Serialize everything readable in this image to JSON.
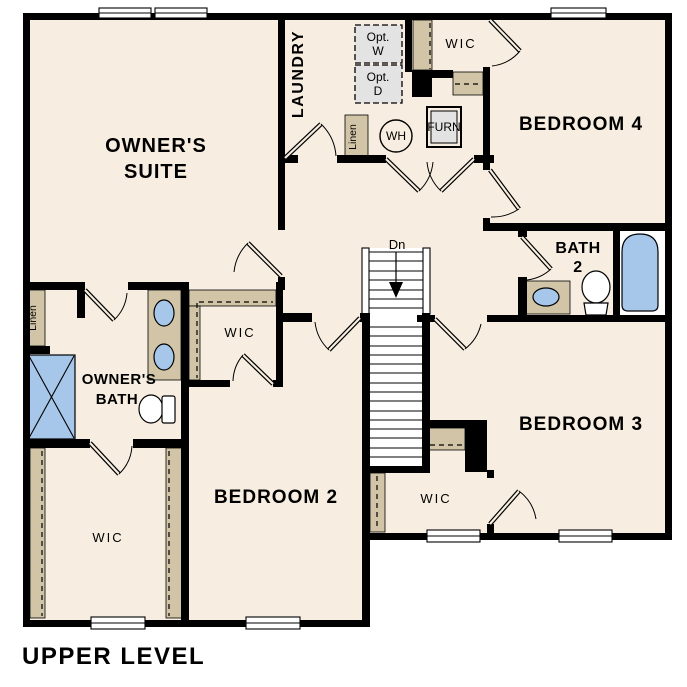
{
  "colors": {
    "floor": "#f7eee1",
    "wall": "#000000",
    "shelf": "#d2c4a7",
    "appliance": "#e3e3e3",
    "fixture": "#a6c7e9",
    "window": "#ffffff"
  },
  "caption": "UPPER LEVEL",
  "rooms": {
    "owners_suite": {
      "line1": "OWNER'S",
      "line2": "SUITE"
    },
    "laundry": {
      "label": "LAUNDRY"
    },
    "bedroom_2": {
      "label": "BEDROOM 2"
    },
    "bedroom_3": {
      "label": "BEDROOM 3"
    },
    "bedroom_4": {
      "label": "BEDROOM 4"
    },
    "owners_bath": {
      "line1": "OWNER'S",
      "line2": "BATH"
    },
    "bath_2": {
      "line1": "BATH",
      "line2": "2"
    }
  },
  "closets": {
    "owners_wic": "WIC",
    "bedroom2_wic": "WIC",
    "bedroom3_wic": "WIC",
    "bedroom4_wic": "WIC",
    "hall_linen": "Linen",
    "laundry_linen": "Linen"
  },
  "equipment": {
    "water_heater": "WH",
    "furnace": "FURN",
    "opt_washer": {
      "line1": "Opt.",
      "line2": "W"
    },
    "opt_dryer": {
      "line1": "Opt.",
      "line2": "D"
    }
  },
  "stairs": {
    "direction": "Dn"
  }
}
